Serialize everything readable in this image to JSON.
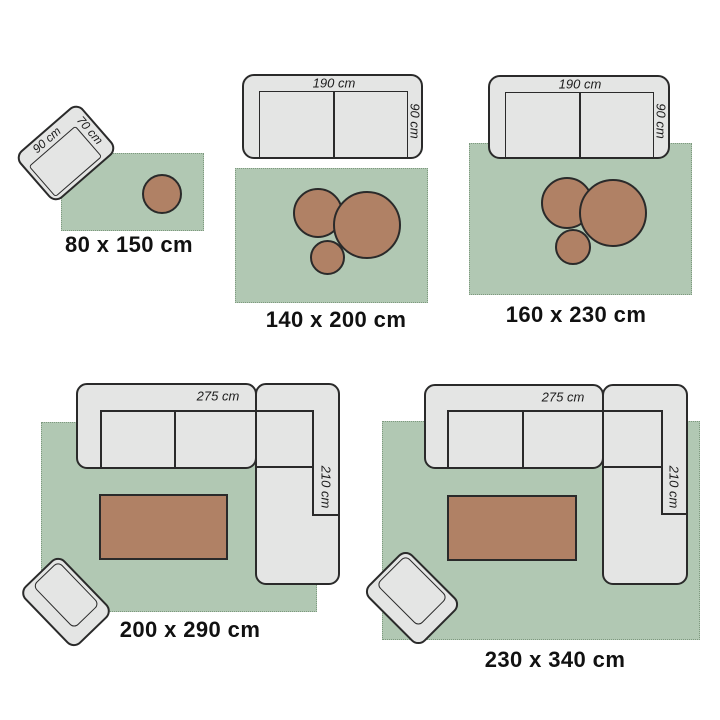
{
  "page": {
    "description": "Rug size guide comparing five rug sizes with top-view furniture for scale"
  },
  "colors": {
    "rug_green": "#b1c8b3",
    "rug_fringe": "#7e997f",
    "furniture_fill": "#e4e5e4",
    "outline": "#2a2a2a",
    "table_brown": "#b08165",
    "label_text": "#111111",
    "dim_text": "#1c1c1c"
  },
  "scenes": [
    {
      "size_label": "80 x 150 cm",
      "labels": {
        "width": "90 cm",
        "depth": "70 cm"
      }
    },
    {
      "size_label": "140 x 200 cm",
      "labels": {
        "width": "190 cm",
        "depth": "90 cm"
      }
    },
    {
      "size_label": "160 x 230 cm",
      "labels": {
        "width": "190 cm",
        "depth": "90 cm"
      }
    },
    {
      "size_label": "200 x 290 cm",
      "labels": {
        "width": "275 cm",
        "depth": "210 cm"
      }
    },
    {
      "size_label": "230 x 340 cm",
      "labels": {
        "width": "275 cm",
        "depth": "210 cm"
      }
    }
  ]
}
